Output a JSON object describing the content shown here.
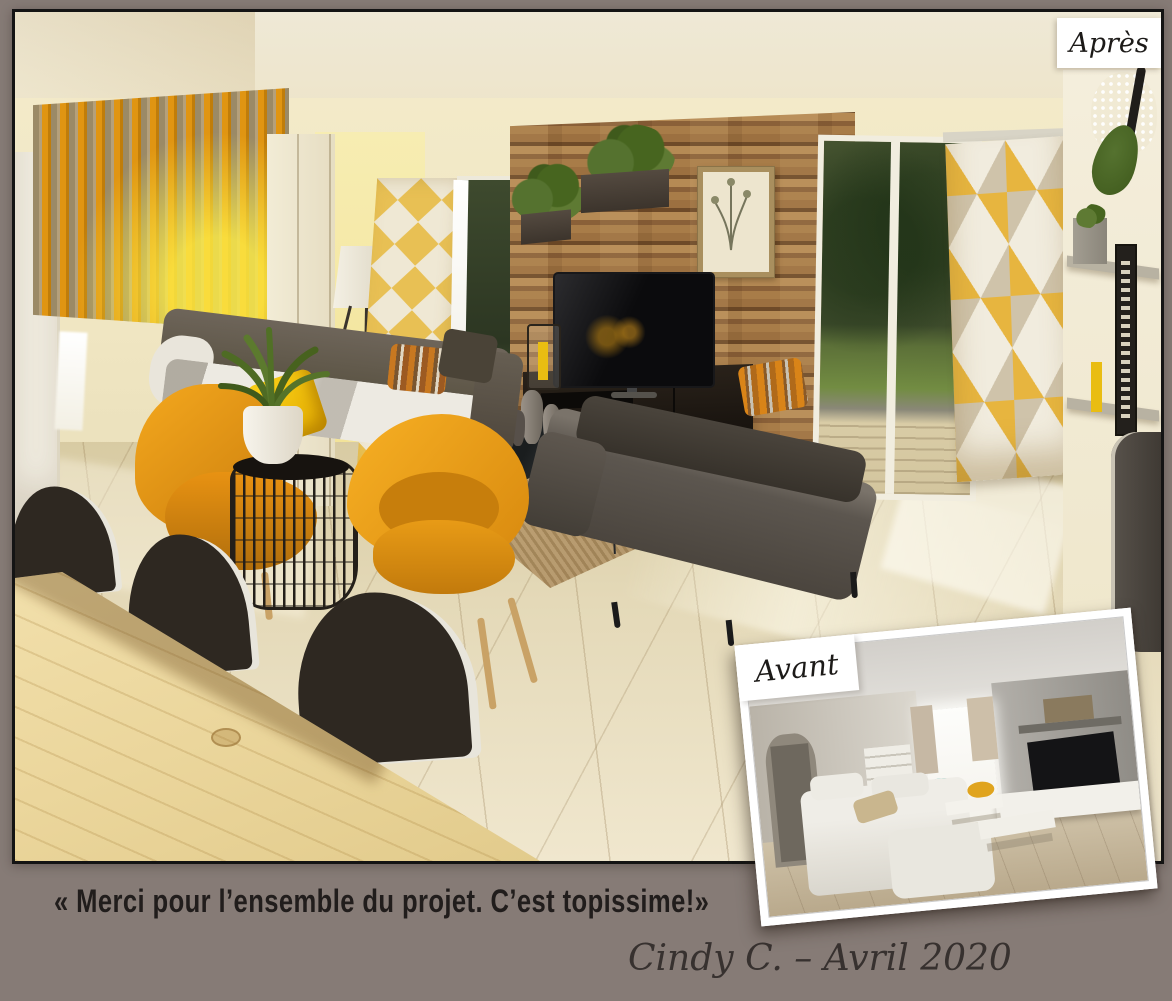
{
  "page": {
    "background_color": "#867B76",
    "frame_border_color": "#141414"
  },
  "after_panel": {
    "label": "Après"
  },
  "before_panel": {
    "label": "Avant"
  },
  "testimonial": {
    "quote": "« Merci pour l’ensemble du projet. C’est topissime!»",
    "signature": "Cindy C. – Avril 2020"
  },
  "colors": {
    "accent_mustard": "#E89A18",
    "accent_yellow": "#F7C90A",
    "wood_wall": "#97744A",
    "sofa_gray": "#57514B",
    "floor_beige": "#E3D7B4",
    "curtain_yellow": "#E7B53F"
  }
}
